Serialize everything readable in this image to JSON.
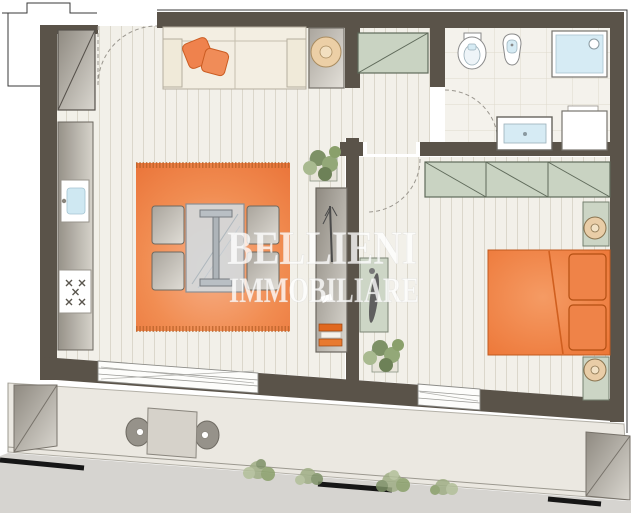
{
  "watermark": {
    "line1": "BELLIENI",
    "line2": "IMMOBILIARE"
  },
  "palette": {
    "wall": "#5a5349",
    "floor_plank": "#f2f0e9",
    "plank_line": "#dbd7cb",
    "tile_floor": "#f4f2ec",
    "accent_orange": "#ef7a3d",
    "pillow_orange": "#ef824d",
    "cabinet_green": "#c9d3c2",
    "cabinet_gray": "#a39e95",
    "glass_blue": "#d6ebf4",
    "balcony_floor": "#ebe8e1",
    "ground_gray": "#d6d4d0",
    "plant_green": "#8aa06b"
  },
  "plan": {
    "type": "apartment-floor-plan",
    "rooms": [
      {
        "id": "living-dining-kitchen",
        "items": [
          "entry door",
          "entry closet",
          "kitchen counter",
          "kitchen sink",
          "cooktop with five burners",
          "sofa with two orange cushions",
          "side table with round lamp",
          "orange rug",
          "glass dining table",
          "four chairs",
          "shelf unit with books",
          "two potted plants"
        ]
      },
      {
        "id": "hallway",
        "items": [
          "wardrobe with diagonal marking"
        ]
      },
      {
        "id": "bathroom",
        "items": [
          "toilet",
          "bidet",
          "shower tray",
          "washbasin cabinet",
          "washing machine",
          "door swing"
        ]
      },
      {
        "id": "bedroom",
        "items": [
          "three-section wardrobe",
          "double bed with orange cover and two pillows",
          "two nightstands with round lamps",
          "green console with decor",
          "door swing",
          "window"
        ]
      },
      {
        "id": "balcony",
        "items": [
          "square table",
          "two chairs",
          "left storage box",
          "right storage box",
          "shrubs",
          "railing",
          "street markings"
        ]
      }
    ]
  }
}
